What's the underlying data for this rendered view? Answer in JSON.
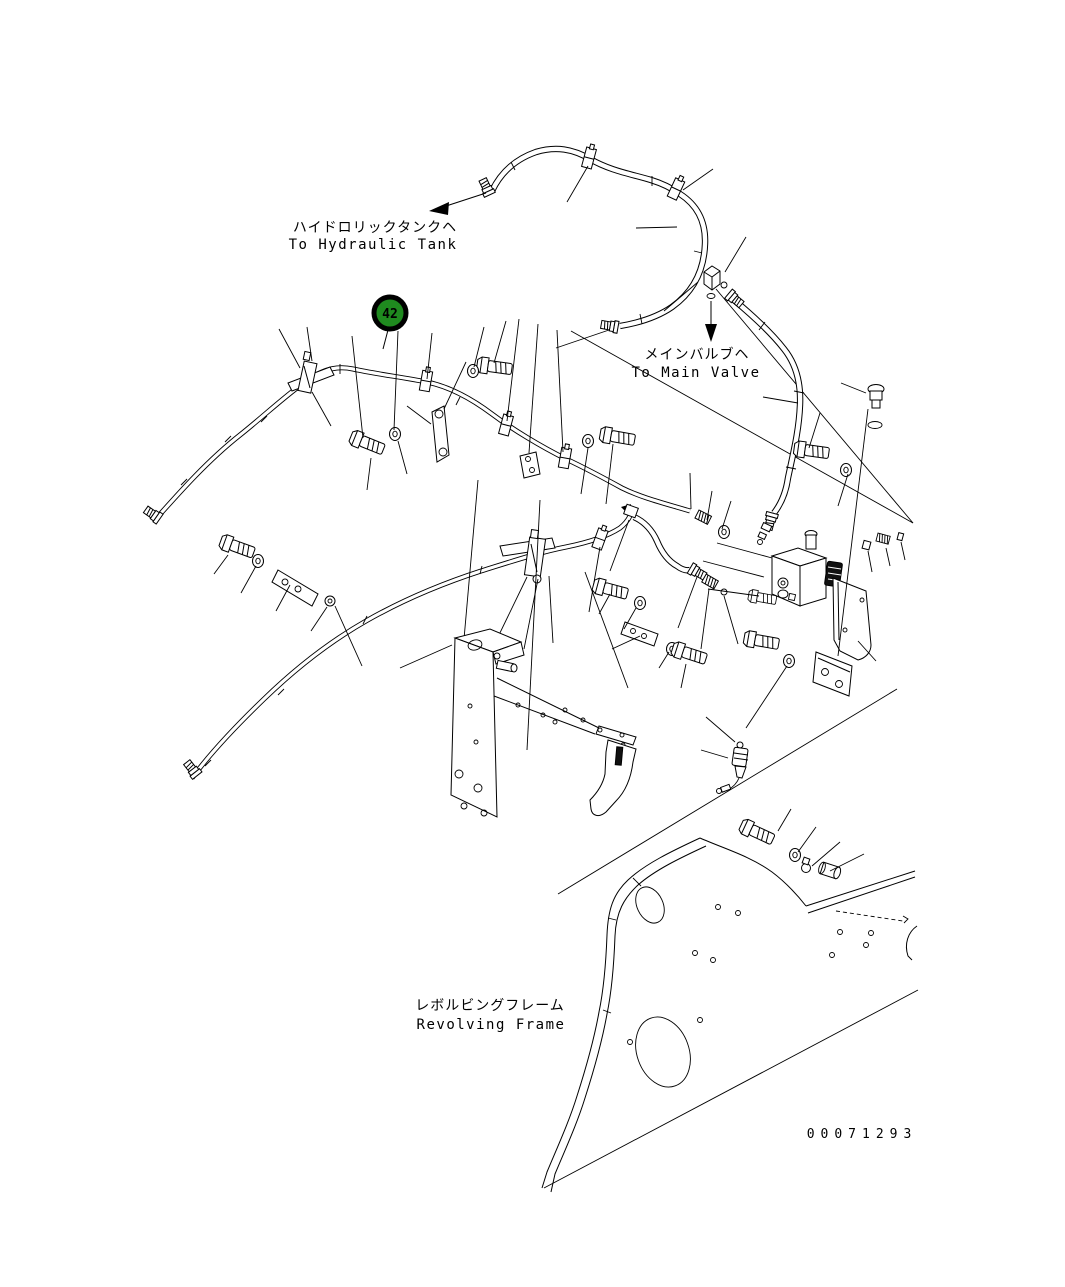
{
  "drawing": {
    "number": "00071293",
    "background_color": "#ffffff",
    "line_color": "#000000"
  },
  "callout": {
    "number": "42",
    "fill_color": "#1f8a1f",
    "ring_color": "#000000",
    "text_color": "#ffffff"
  },
  "labels": {
    "hydraulic_tank": {
      "jp": "ハイドロリックタンクヘ",
      "en": "To Hydraulic Tank"
    },
    "main_valve": {
      "jp": "メインバルブヘ",
      "en": "To Main Valve"
    },
    "revolving_frame": {
      "jp": "レボルビングフレーム",
      "en": "Revolving Frame"
    }
  }
}
